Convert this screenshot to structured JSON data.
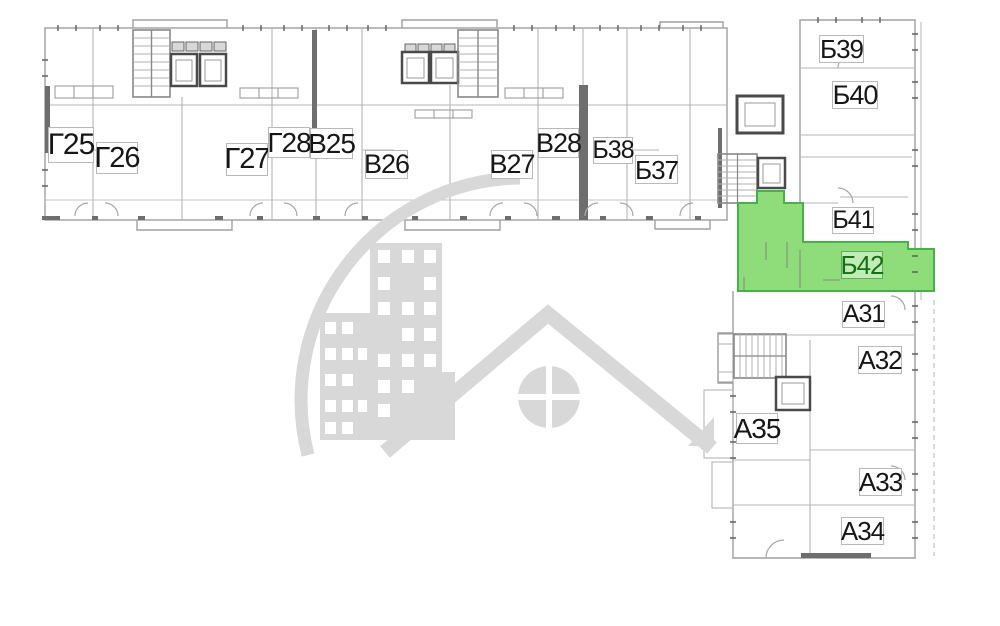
{
  "plan": {
    "colors": {
      "background": "#ffffff",
      "outline": "#a0a0a0",
      "interior_line": "#b4b4b4",
      "wall_dark": "#6e6e6e",
      "watermark": "#d8d8d8"
    },
    "highlight": {
      "fill": "#8fdc7b",
      "border": "#49b149",
      "label_color": "#156f15"
    },
    "watermark_icon": "building-with-roof-logo",
    "units": [
      {
        "label": "Г25",
        "highlighted": false
      },
      {
        "label": "Г26",
        "highlighted": false
      },
      {
        "label": "Г27",
        "highlighted": false
      },
      {
        "label": "Г28",
        "highlighted": false
      },
      {
        "label": "В25",
        "highlighted": false
      },
      {
        "label": "В26",
        "highlighted": false
      },
      {
        "label": "В27",
        "highlighted": false
      },
      {
        "label": "В28",
        "highlighted": false
      },
      {
        "label": "Б38",
        "highlighted": false
      },
      {
        "label": "Б37",
        "highlighted": false
      },
      {
        "label": "Б39",
        "highlighted": false
      },
      {
        "label": "Б40",
        "highlighted": false
      },
      {
        "label": "Б41",
        "highlighted": false
      },
      {
        "label": "Б42",
        "highlighted": true
      },
      {
        "label": "А31",
        "highlighted": false
      },
      {
        "label": "А32",
        "highlighted": false
      },
      {
        "label": "А35",
        "highlighted": false
      },
      {
        "label": "А33",
        "highlighted": false
      },
      {
        "label": "А34",
        "highlighted": false
      }
    ]
  }
}
